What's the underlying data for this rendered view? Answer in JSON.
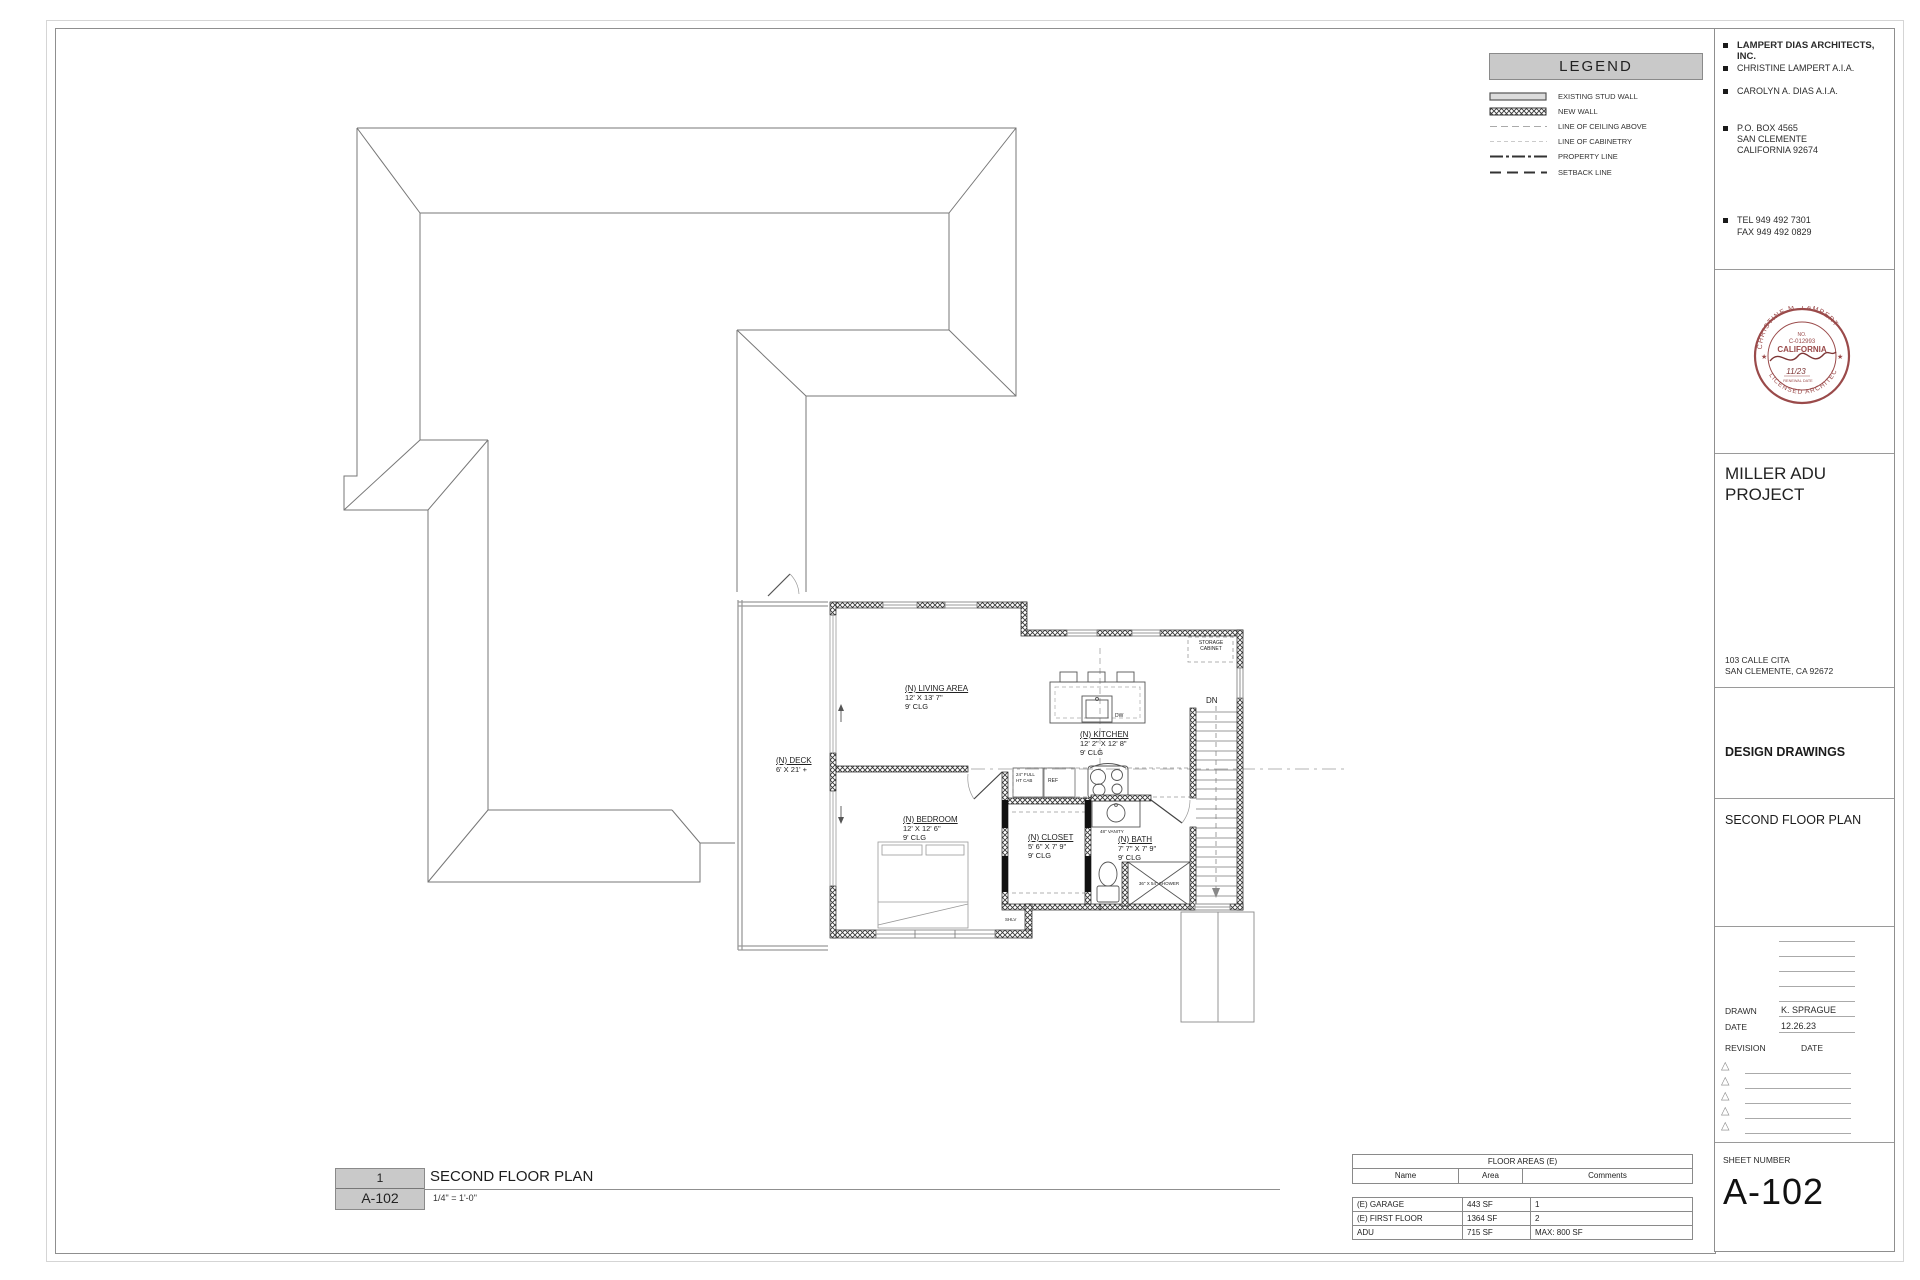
{
  "legend": {
    "title": "LEGEND",
    "items": [
      {
        "label": "EXISTING STUD WALL",
        "symbol": "existing-stud-wall"
      },
      {
        "label": "NEW WALL",
        "symbol": "new-wall-hatch"
      },
      {
        "label": "LINE OF CEILING ABOVE",
        "symbol": "dashed-gray"
      },
      {
        "label": "LINE OF CABINETRY",
        "symbol": "dashed-light"
      },
      {
        "label": "PROPERTY LINE",
        "symbol": "dash-dot-heavy"
      },
      {
        "label": "SETBACK LINE",
        "symbol": "long-dash-heavy"
      }
    ]
  },
  "title_block": {
    "firm": "LAMPERT DIAS ARCHITECTS, INC.",
    "architect1": "CHRISTINE LAMPERT A.I.A.",
    "architect2": "CAROLYN A. DIAS  A.I.A.",
    "address1": "P.O. BOX 4565",
    "address2": "SAN CLEMENTE",
    "address3": "CALIFORNIA 92674",
    "tel": "TEL 949 492 7301",
    "fax": "FAX 949 492 0829",
    "stamp": {
      "arc_top": "CHRISTINE M. LAMPERT",
      "arc_bottom": "LICENSED ARCHITECT",
      "no_label": "NO.",
      "license_no": "C-012993",
      "state": "CALIFORNIA",
      "date": "11/23",
      "renewal": "RENEWAL DATE",
      "color": "#9a4a4a"
    },
    "project_title": "MILLER ADU PROJECT",
    "project_address1": "103 CALLE CITA",
    "project_address2": "SAN CLEMENTE, CA 92672",
    "phase": "DESIGN DRAWINGS",
    "sheet_title": "SECOND FLOOR PLAN",
    "drawn_label": "DRAWN",
    "drawn_value": "K. SPRAGUE",
    "date_label": "DATE",
    "date_value": "12.26.23",
    "revision_label": "REVISION",
    "revision_date_label": "DATE",
    "sheet_number_label": "SHEET NUMBER",
    "sheet_number": "A-102"
  },
  "drawing_title": {
    "detail_number": "1",
    "detail_sheet": "A-102",
    "title": "SECOND FLOOR PLAN",
    "scale": "1/4\" = 1'-0\""
  },
  "floor_areas": {
    "title": "FLOOR AREAS (E)",
    "headers": [
      "Name",
      "Area",
      "Comments"
    ],
    "rows": [
      [
        "(E) GARAGE",
        "443 SF",
        "1"
      ],
      [
        "(E) FIRST FLOOR",
        "1364 SF",
        "2"
      ],
      [
        "ADU",
        "715 SF",
        "MAX: 800 SF"
      ]
    ]
  },
  "plan": {
    "living": {
      "name": "(N) LIVING AREA",
      "dims": "12' X 13' 7\"",
      "clg": "9' CLG"
    },
    "kitchen": {
      "name": "(N) KITCHEN",
      "dims": "12' 2\" X 12' 8\"",
      "clg": "9' CLG"
    },
    "bedroom": {
      "name": "(N) BEDROOM",
      "dims": "12' X 12' 6\"",
      "clg": "9' CLG"
    },
    "closet": {
      "name": "(N) CLOSET",
      "dims": "5' 6\" X 7' 9\"",
      "clg": "9' CLG"
    },
    "bath": {
      "name": "(N) BATH",
      "dims": "7' 7\" X 7' 9\"",
      "clg": "9' CLG"
    },
    "deck": {
      "name": "(N) DECK",
      "dims": "6' X 21' +"
    },
    "labels": {
      "storage": "STORAGE CABINET",
      "dn": "DN",
      "ref": "REF",
      "dw": "DW",
      "cab": "24\" FULL HT CAB",
      "vanity": "48\" VANITY",
      "shower": "36\" X 54\" SHOWER",
      "shlv": "SHLV"
    }
  }
}
